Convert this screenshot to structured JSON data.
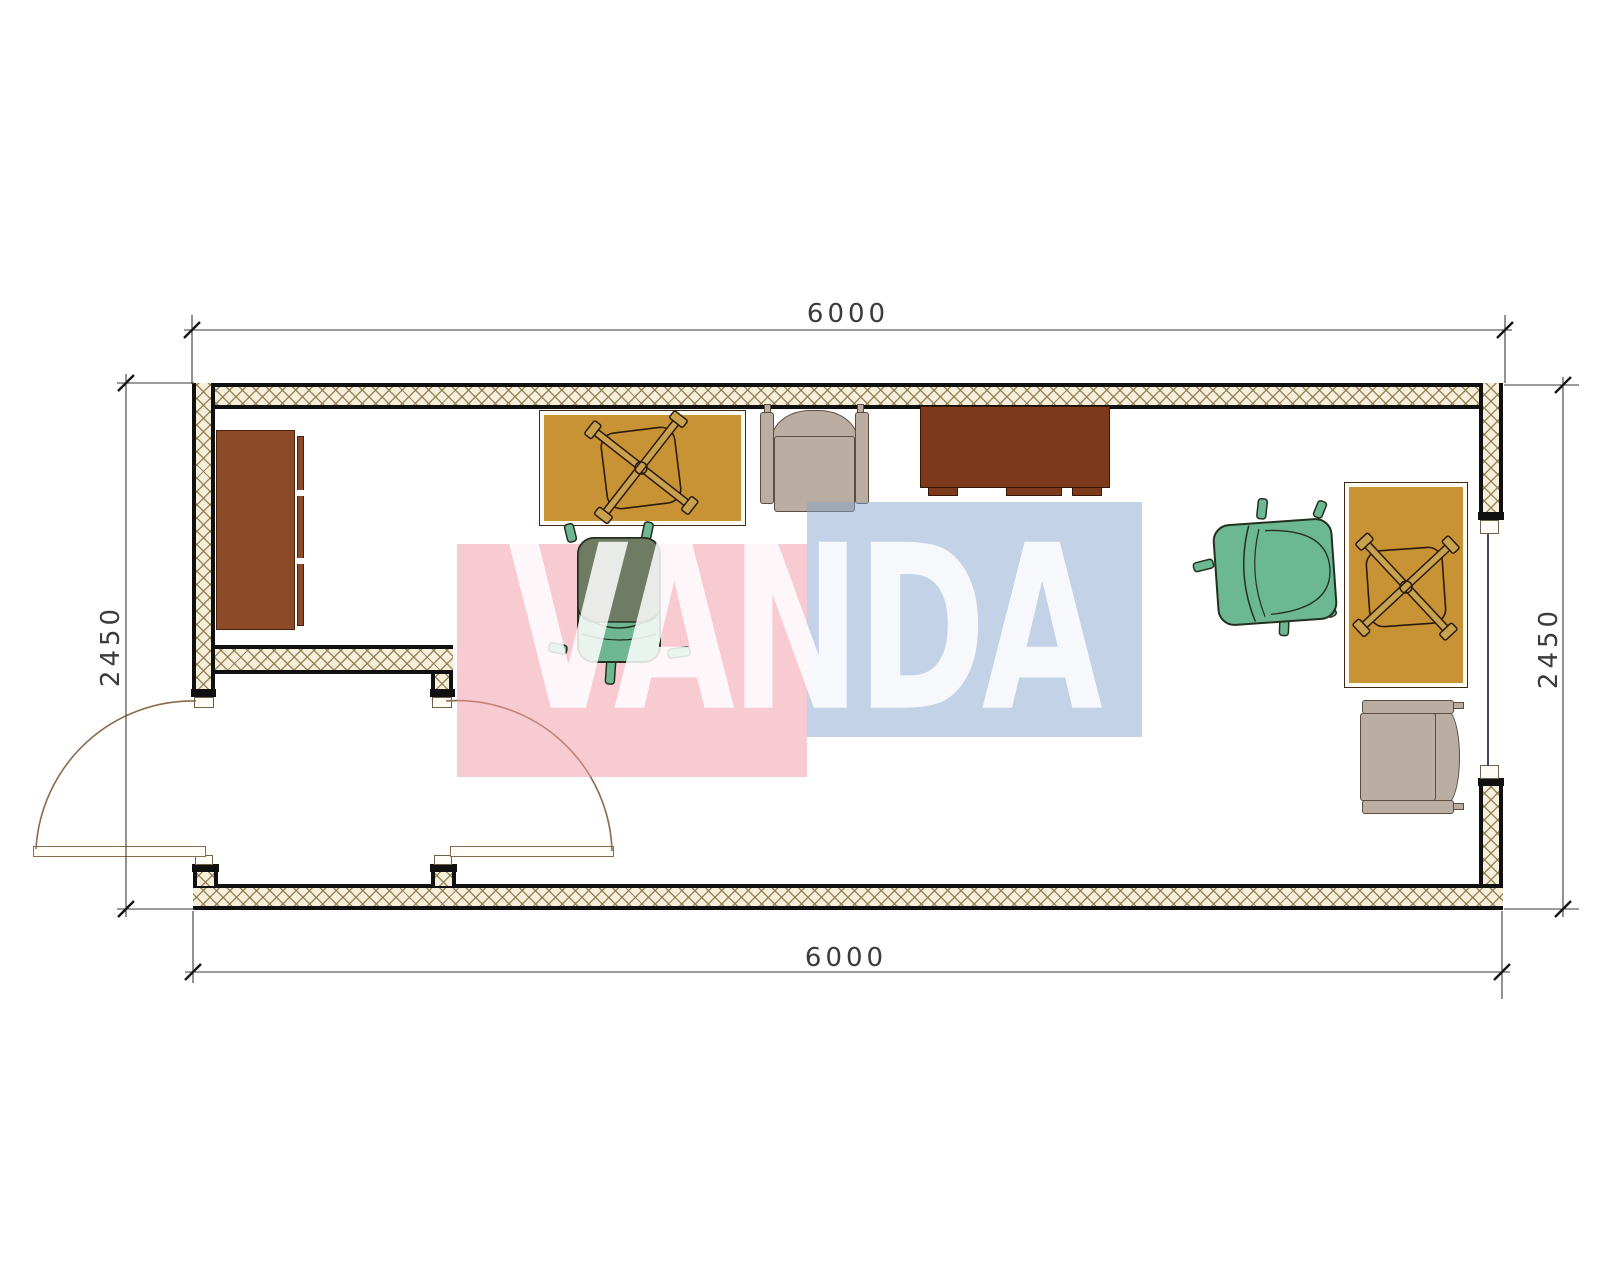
{
  "drawing": {
    "type": "floor-plan",
    "background": "#ffffff",
    "room": {
      "width_mm": "6000",
      "depth_mm": "2450"
    }
  },
  "dimensions": {
    "top": "6000",
    "bottom": "6000",
    "left": "2450",
    "right": "2450",
    "line_color": "#3a3a3a",
    "text_color": "#3b3b3b"
  },
  "watermark": {
    "text": "VANDA",
    "pink": "#f19bab",
    "blue": "#87a5cd",
    "text_color": "#ffffff"
  },
  "walls": {
    "fill": "#f6efdc",
    "hatch_line": "#8a7748",
    "edge": "#101010",
    "window_glass": "#3c4a66",
    "door_arc": "#8a6b4a"
  },
  "furniture": {
    "cabinet_left": {
      "label": "cabinet",
      "color": "#8d4a29"
    },
    "desk_top": {
      "label": "desk",
      "color": "#c79335"
    },
    "desk_right": {
      "label": "desk",
      "color": "#c79335"
    },
    "sideboard_top": {
      "label": "sideboard",
      "color": "#7c3a1b"
    },
    "armchair_top": {
      "label": "armchair",
      "color": "#b9aea1"
    },
    "armchair_bottom": {
      "label": "armchair",
      "color": "#b9aea1"
    },
    "office_chair_left": {
      "label": "office chair",
      "back": "#6f7c63",
      "seat": "#6fb792"
    },
    "office_chair_right": {
      "label": "office chair",
      "color": "#6cb794"
    }
  }
}
